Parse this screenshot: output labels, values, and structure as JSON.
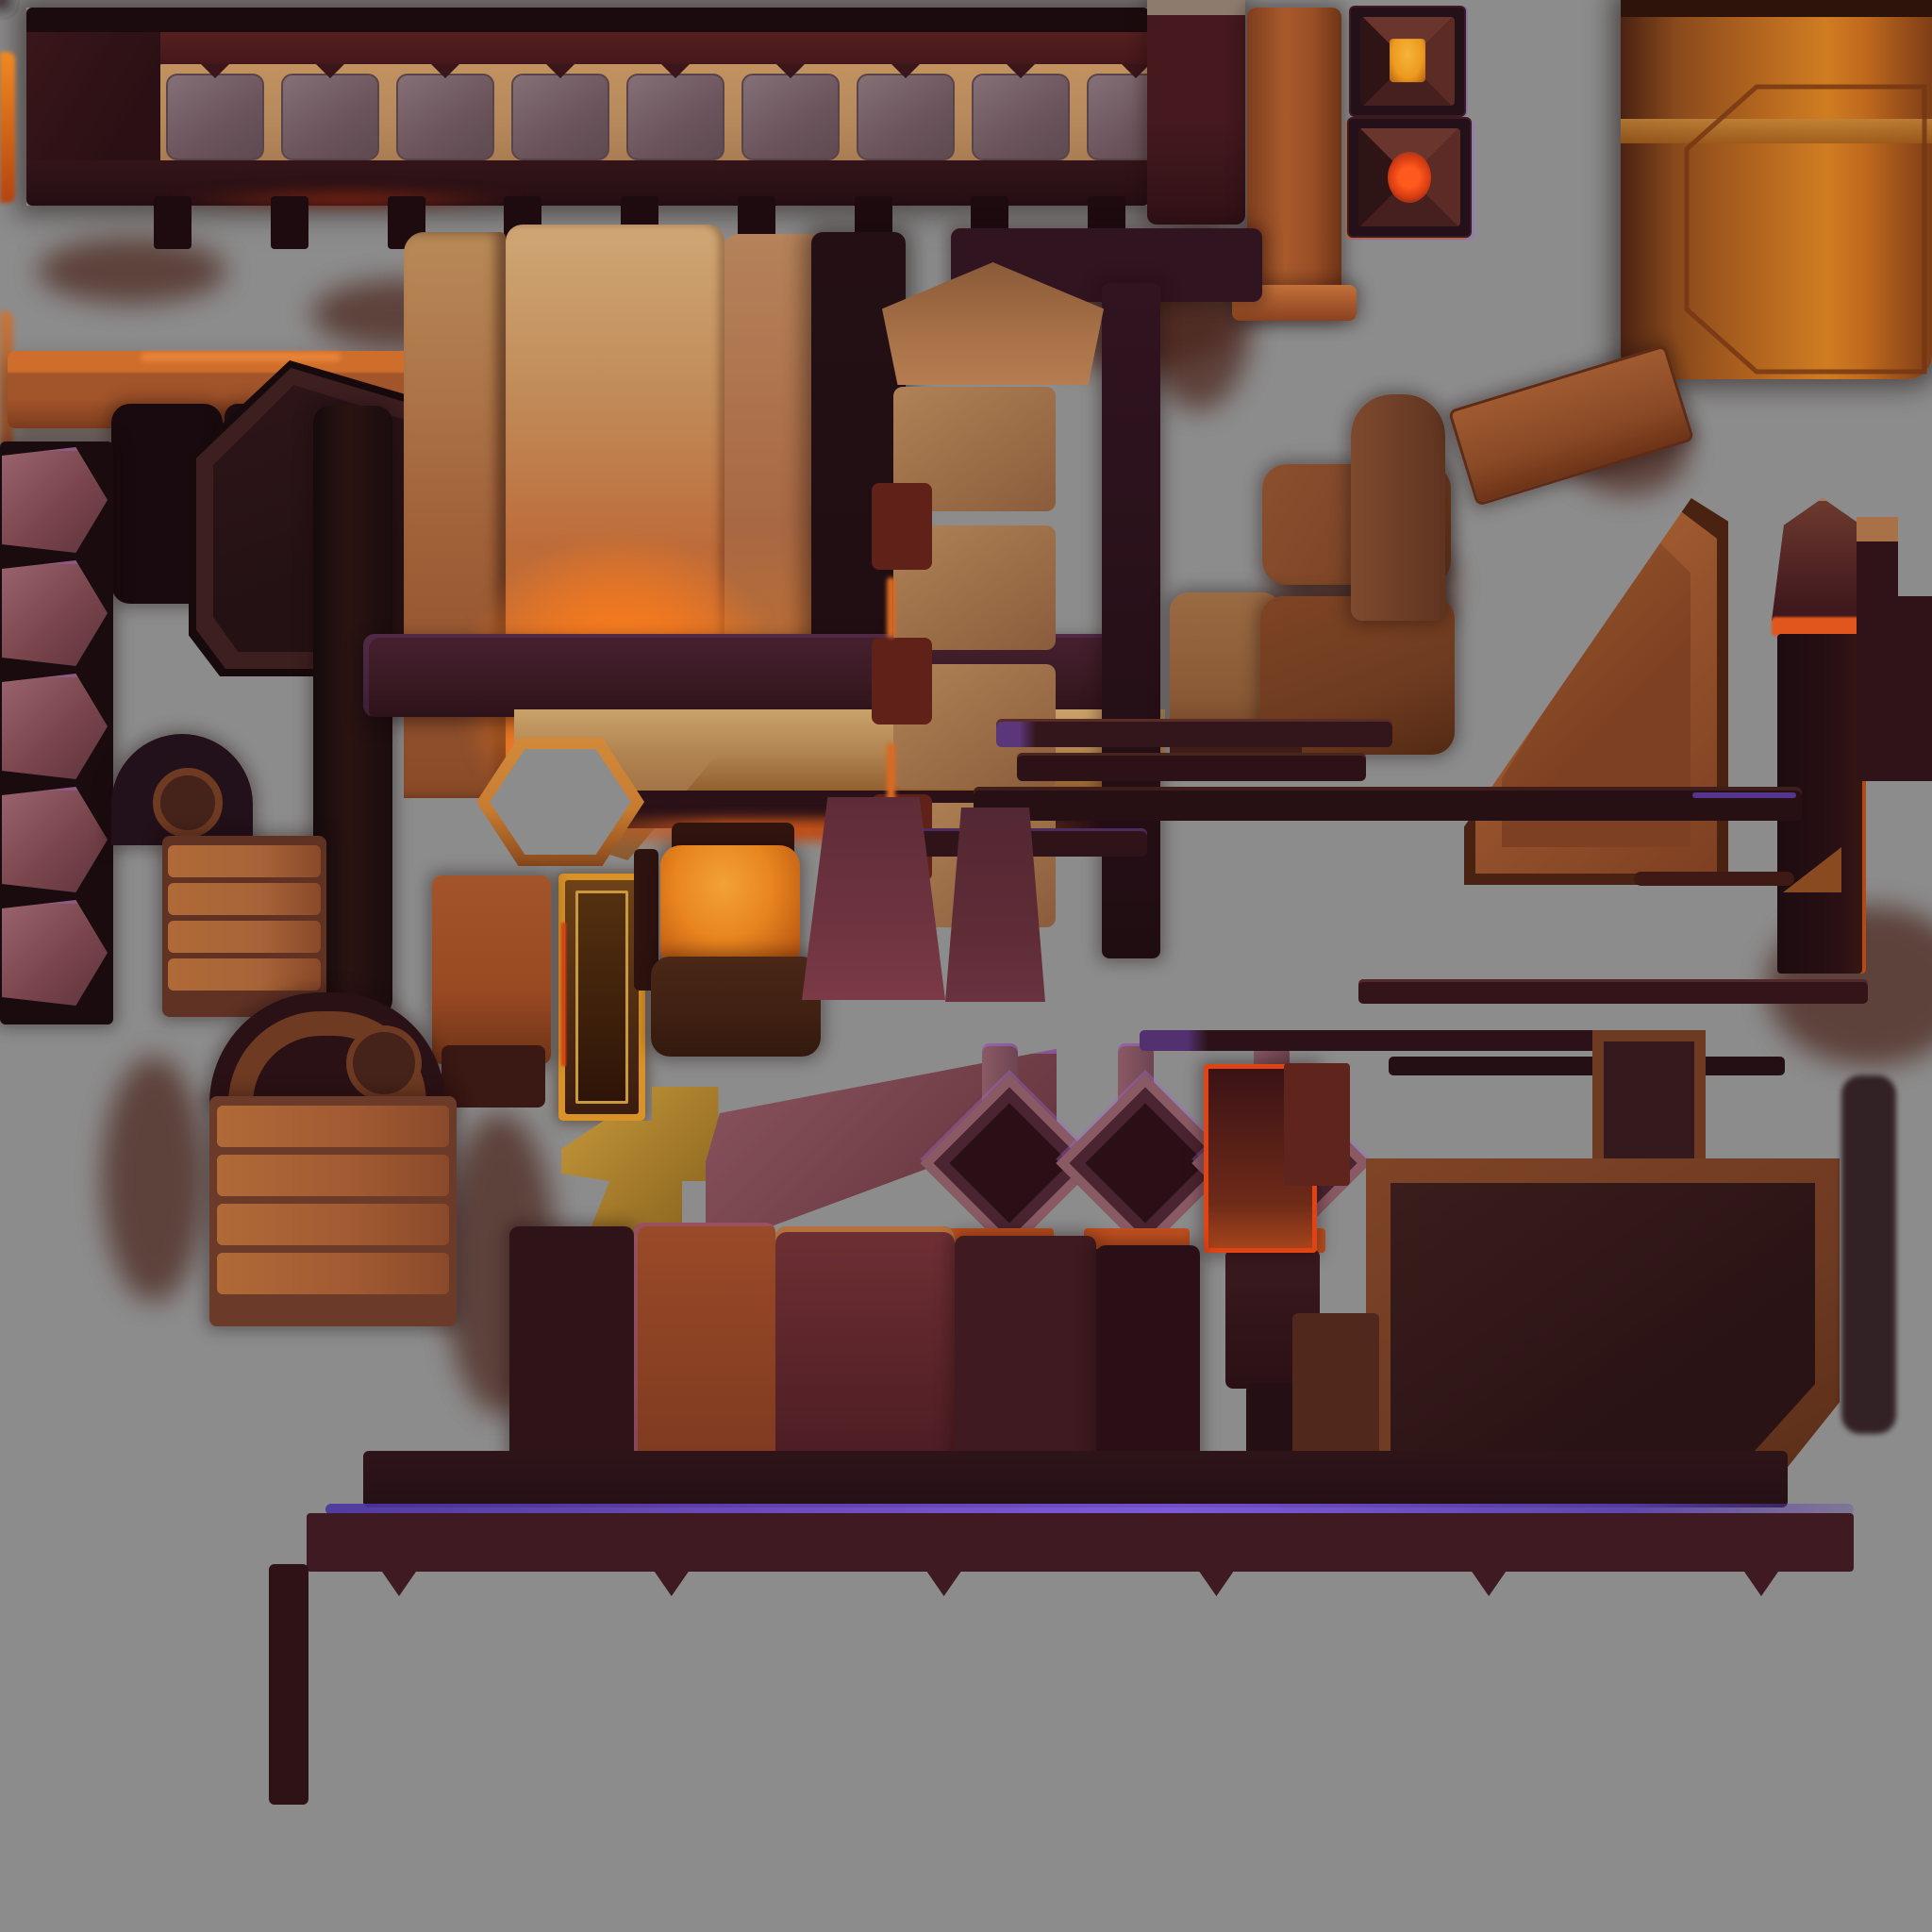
{
  "meta": {
    "kind": "hand-painted game texture atlas (trim sheet)",
    "theme": "dark forge-lit wooden and stone architectural trims",
    "background_color": "#8c8c8c",
    "text_content": "none - image contains no readable text"
  },
  "palette": {
    "canvas_gray": "#8c8c8c",
    "deep_shadow": "#170a0d",
    "dark_wood": "#241014",
    "maroon": "#47181c",
    "maroon_band": "#3f1a22",
    "tan_grout": "#b5885c",
    "stone_panel": "#6f575e",
    "stone_light": "#857077",
    "purple_glow": "#7a55e0",
    "purple_soft": "#5a3fae",
    "amber_core": "#ed9a1e",
    "ember_core": "#e0481a",
    "orange_glow": "#ef6a1a",
    "orange_rim": "#e35f1e",
    "rust": "#9a4f28",
    "barrel_light": "#cf7d22",
    "forge_glow": "#f07820",
    "gold": "#c89a3c",
    "mauve_chevron": "#8a555c",
    "plaque_mauve": "#8a5a64"
  },
  "repeats": {
    "top_panels": 9,
    "top_posts": 9,
    "bottom_panels": 11,
    "bottom_posts": 12,
    "bottom_teeth": 6,
    "chevron_segments": 5,
    "pillar_blocks": 4,
    "crate_slats": 4,
    "stack_slats": 4,
    "plaques": 3
  },
  "pieces": [
    {
      "name": "top-trim-beam",
      "desc": "long horizontal beam, stone panels in tan wood frame, hanging posts, purple glow accent right half"
    },
    {
      "name": "beam-end-cap",
      "desc": "dark maroon block capping beam right end"
    },
    {
      "name": "plank-column",
      "desc": "rust-orange vertical plank with flared foot"
    },
    {
      "name": "lamp-tile-amber",
      "desc": "square pyramid lamp tile, amber core"
    },
    {
      "name": "lamp-tile-ember",
      "desc": "square pyramid lamp tile, red-orange core"
    },
    {
      "name": "barrel-pillar",
      "desc": "large orange metal cylinder with seam and octagonal inset, top right"
    },
    {
      "name": "shelf-plank",
      "desc": "glowing-edged orange shelf plank, upper left"
    },
    {
      "name": "block-cluster",
      "desc": "small dark slabs and bracket with ember edge"
    },
    {
      "name": "hex-nut-ring",
      "desc": "octagonal ring washer"
    },
    {
      "name": "angled-panel",
      "desc": "large slanted framed dark wood panel"
    },
    {
      "name": "chevron-strip",
      "desc": "vertical strip of mauve chevron shields, left edge"
    },
    {
      "name": "side-post",
      "desc": "segmented dark post"
    },
    {
      "name": "forge-wall",
      "desc": "plank wall glowing hot orange at its base with dark column"
    },
    {
      "name": "mantle-beam",
      "desc": "dark purple-tinted mantle slab"
    },
    {
      "name": "corbel-beam",
      "desc": "tan corbel beam with sloped foot"
    },
    {
      "name": "stone-pillar",
      "desc": "stacked stone block pillar with pointed tan cap and side notches"
    },
    {
      "name": "t-beam",
      "desc": "dark T-shaped spine beam"
    },
    {
      "name": "seat-slabs",
      "desc": "rounded brown slabs"
    },
    {
      "name": "tilted-plank",
      "desc": "leaning framed plank"
    },
    {
      "name": "ramp-wedge",
      "desc": "large diagonal wooden wedge ramp"
    },
    {
      "name": "obelisk",
      "desc": "pointed dark pillar with ember neck band"
    },
    {
      "name": "flag-triangle",
      "desc": "small triangle on thin rod"
    },
    {
      "name": "rod-planks",
      "desc": "thin horizontal rods with purple accents"
    },
    {
      "name": "hex-ring",
      "desc": "hexagonal amber outline ring"
    },
    {
      "name": "gold-frame-bar",
      "desc": "gold-rimmed vertical frame bar"
    },
    {
      "name": "gold-bracket",
      "desc": "gold key/bracket shaped fitting"
    },
    {
      "name": "glow-canister",
      "desc": "orange glowing canister with dark base"
    },
    {
      "name": "rust-panel",
      "desc": "rust-red rounded panel"
    },
    {
      "name": "curtain-trapezoids",
      "desc": "two flaring maroon trapezoid pillars"
    },
    {
      "name": "pulley-half",
      "desc": "dark half disc with hub"
    },
    {
      "name": "plank-stack",
      "desc": "stack of four orange slats"
    },
    {
      "name": "wheel-arch",
      "desc": "半 circular arch with concentric bands and hub"
    },
    {
      "name": "slat-crate",
      "desc": "crate of horizontal slats"
    },
    {
      "name": "diamond-plaques",
      "desc": "row of pointed plaques with dark diamond insets and skirts"
    },
    {
      "name": "purple-plank",
      "desc": "angled mauve plank with purple sheen"
    },
    {
      "name": "orange-frame-red",
      "desc": "red-orange rimmed open frame"
    },
    {
      "name": "block-row",
      "desc": "row of heavy dark and rust blocks"
    },
    {
      "name": "stepped-panel",
      "desc": "large L-stepped framed dark panel, chamfered corner"
    },
    {
      "name": "bottom-trim-beam",
      "desc": "long bottom beam: purple glow line, chevron band, stone panels, rail and ember glow bar"
    },
    {
      "name": "corner-frame",
      "desc": "huge gold-rimmed L corner frame, bottom left"
    },
    {
      "name": "slim-lantern-tower",
      "desc": "narrow pointed tower with ember band and red foot"
    },
    {
      "name": "big-lantern-tower",
      "desc": "wide pointed dark tower with ember band, arm and red foot"
    },
    {
      "name": "footer-blocks",
      "desc": "assorted dark footer blocks, coil spring, ember glow streak"
    }
  ]
}
